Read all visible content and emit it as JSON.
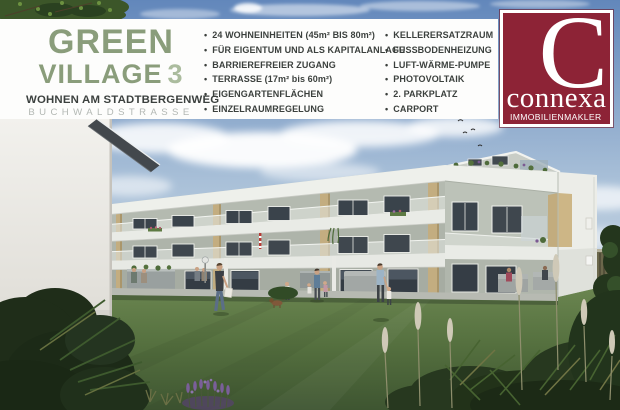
{
  "scene": {
    "description": "3D architectural rendering of a modern L-shaped apartment complex with three floors, white balcony bands, tan pilasters, courtyard lawn with residents, ferns, lavender and pampas grass"
  },
  "banner": {
    "logo": {
      "title": "GREEN",
      "title_line2": "VILLAGE",
      "title_number": "3",
      "subtitle": "WOHNEN AM STADTBERGENWEG",
      "street": "BUCHWALDSTRASSE",
      "color_primary": "#8a9d7b",
      "color_number": "#abbc9e",
      "color_subtitle": "#3b403e",
      "color_street": "#b3b8b4"
    },
    "features_left": [
      "24 WOHNEINHEITEN (45m² BIS 80m²)",
      "FÜR EIGENTUM UND ALS KAPITALANLAGE",
      "BARRIEREFREIER ZUGANG",
      "TERRASSE (17m² bis 60m²)",
      "EIGENGARTENFLÄCHEN",
      "EINZELRAUMREGELUNG"
    ],
    "features_right": [
      "KELLERERSATZRAUM",
      "FUSSBODENHEIZUNG",
      "LUFT-WÄRME-PUMPE",
      "PHOTOVOLTAIK",
      "2. PARKPLATZ",
      "CARPORT"
    ]
  },
  "broker": {
    "initial": "C",
    "name": "connexa",
    "tagline": "IMMOBILIENMAKLER",
    "brand_color": "#8d2336"
  }
}
